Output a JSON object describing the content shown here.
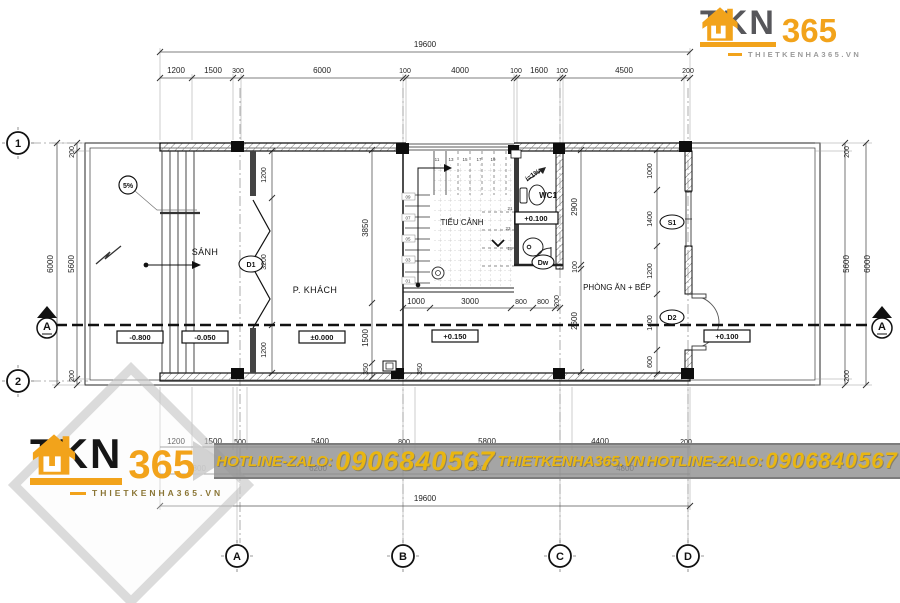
{
  "header_logo": {
    "brand": "TKN",
    "brand_suffix": "365",
    "website": "THIETKENHA365.VN"
  },
  "footer_logo": {
    "brand": "TKN",
    "brand_suffix": "365",
    "website": "THIETKENHA365.VN"
  },
  "banner": {
    "hotline_label_1": "HOTLINE-ZALO:",
    "phone_1": "0906840567",
    "website": "THIETKENHA365.VN",
    "hotline_label_2": "HOTLINE-ZALO:",
    "phone_2": "0906840567"
  },
  "plan": {
    "rooms": {
      "hall": "SÁNH",
      "living": "P. KHÁCH",
      "courtyard": "TIỂU CẢNH",
      "wc": "WC1",
      "kitchen": "PHÒNG ĂN + BẾP"
    },
    "levels": {
      "ramp": "-0.800",
      "hall": "-0.050",
      "living": "±0.000",
      "terrace": "+0.150",
      "wc": "+0.100",
      "backyard": "+0.100"
    },
    "tags": {
      "door_main": "D1",
      "door_back": "D2",
      "door_wc": "Dw",
      "window": "S1"
    },
    "slopes": {
      "ramp": "5%",
      "wc": "i=1%"
    },
    "grid": {
      "row1": "1",
      "row2": "2",
      "col_a": "A",
      "col_b": "B",
      "col_c": "C",
      "col_d": "D",
      "section": "A"
    },
    "dims": {
      "top_total": "19600",
      "top": [
        "1200",
        "1500",
        "300",
        "6000",
        "100",
        "4000",
        "100",
        "1600",
        "100",
        "4500",
        "200"
      ],
      "left_total": "6000",
      "left": [
        "200",
        "5600",
        "200"
      ],
      "right_total": "6000",
      "right": [
        "200",
        "5600",
        "200"
      ],
      "bottom_total": "19600",
      "bottom_row1": [
        "1200",
        "1500",
        "500",
        "5400",
        "800",
        "5800",
        "4400",
        "200"
      ],
      "bottom_row2": [
        "2800",
        "6200",
        "5800",
        "4800"
      ],
      "door_wall": [
        "1200",
        "3200",
        "1200"
      ],
      "living_depth": [
        "3850",
        "1500",
        "350",
        "350"
      ],
      "stair_row": [
        "1000",
        "3000",
        "800",
        "800",
        "200"
      ],
      "wc_col": [
        "2900",
        "100",
        "2600"
      ],
      "kitchen_col": [
        "1000",
        "1400",
        "1200",
        "1400",
        "600"
      ]
    },
    "stair_numbers": {
      "flight1": [
        "09",
        "07",
        "05",
        "03",
        "01"
      ],
      "flight2": [
        "11",
        "13",
        "15",
        "17",
        "19"
      ],
      "flight3": [
        "21",
        "23",
        "25"
      ]
    }
  },
  "colors": {
    "accent_orange": "#F2A31B",
    "banner_yellow": "#E9B611",
    "banner_gray": "#939393"
  }
}
